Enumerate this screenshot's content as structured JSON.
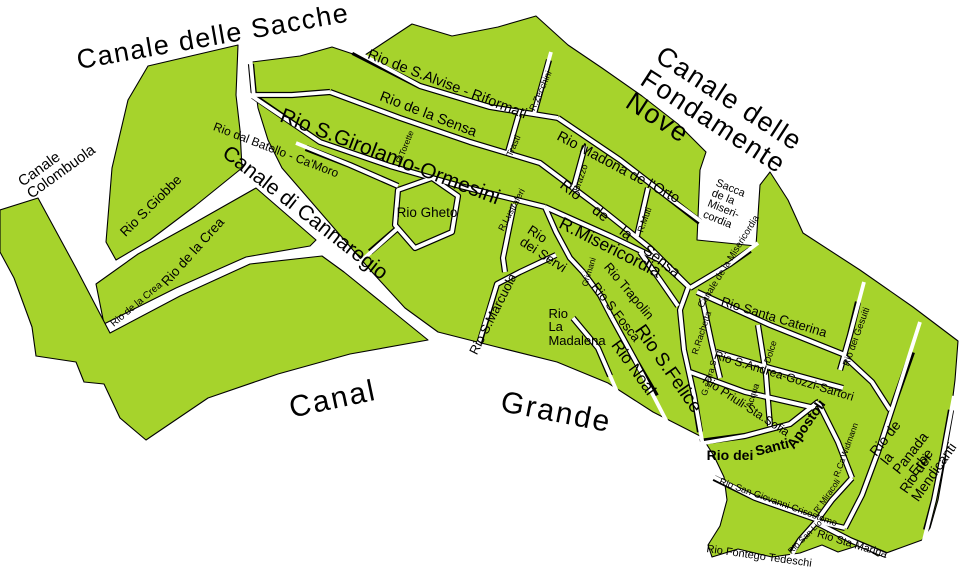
{
  "map": {
    "colors": {
      "water": "#ffffff",
      "land": "#a6d32c",
      "outline": "#000000",
      "text": "#000000"
    },
    "labels": [
      {
        "id": "canale-delle-sacche",
        "text": "Canale delle Sacche",
        "x": 213,
        "y": 37,
        "rot": -10,
        "size": 27,
        "kind": "water",
        "ls": 1.5
      },
      {
        "id": "canale-delle-fondamente-nove",
        "text": "Canale delle Fondamente Nove",
        "x": 737,
        "y": 137,
        "rot": 33,
        "size": 27,
        "kind": "water",
        "ls": 1.5
      },
      {
        "id": "canale-colombuola",
        "text": "Canale\nColombuola",
        "x": 57,
        "y": 166,
        "rot": -36,
        "size": 15,
        "kind": "water",
        "align": "left"
      },
      {
        "id": "canal-grande-1",
        "text": "Canal",
        "x": 333,
        "y": 400,
        "rot": -12,
        "size": 30,
        "kind": "water",
        "ls": 2
      },
      {
        "id": "canal-grande-2",
        "text": "Grande",
        "x": 556,
        "y": 413,
        "rot": 11,
        "size": 30,
        "kind": "water",
        "ls": 2
      },
      {
        "id": "rio-de-s-alvise-riformati",
        "text": "Rio de S.Alvise - Riformati",
        "x": 447,
        "y": 85,
        "rot": 21,
        "size": 14.5
      },
      {
        "id": "rio-de-la-sensa-upper",
        "text": "Rio de la Sensa",
        "x": 428,
        "y": 115,
        "rot": 21,
        "size": 14.5
      },
      {
        "id": "rio-madona-de-l-orto",
        "text": "Rio Madona de l'Orto",
        "x": 618,
        "y": 168,
        "rot": 28,
        "size": 14.5
      },
      {
        "id": "rio-s-girolamo-ormesini",
        "text": "Rio S.Girolamo-Ormesini",
        "x": 390,
        "y": 157,
        "rot": 21,
        "size": 21
      },
      {
        "id": "rio-dal-batello-ca-moro",
        "text": "Rio dal Batello - Ca'Moro",
        "x": 276,
        "y": 150,
        "rot": 21,
        "size": 12
      },
      {
        "id": "canale-di-cannaregio",
        "text": "Canale di Cannaregio",
        "x": 305,
        "y": 213,
        "rot": 38,
        "size": 21
      },
      {
        "id": "rio-gheto",
        "text": "Rio Gheto",
        "x": 427,
        "y": 213,
        "rot": 0,
        "size": 13.5
      },
      {
        "id": "rio-s-giobbe",
        "text": "Rio S.Giobbe",
        "x": 151,
        "y": 206,
        "rot": -45,
        "size": 13.5
      },
      {
        "id": "rio-de-la-crea",
        "text": "Rio de la Crea",
        "x": 193,
        "y": 252,
        "rot": -48,
        "size": 13.5
      },
      {
        "id": "rio-de-la-crea-small",
        "text": "Rio de la Crea",
        "x": 137,
        "y": 305,
        "rot": -40,
        "size": 10
      },
      {
        "id": "r-zecchini",
        "text": "R.Zecchini",
        "x": 541,
        "y": 91,
        "rot": -66,
        "size": 9
      },
      {
        "id": "trasti",
        "text": "Trasti",
        "x": 514,
        "y": 146,
        "rot": -66,
        "size": 9
      },
      {
        "id": "r-torette",
        "text": "R.Torette",
        "x": 405,
        "y": 147,
        "rot": -68,
        "size": 8.5
      },
      {
        "id": "r-lustraferi",
        "text": "R.Lustraferi",
        "x": 512,
        "y": 210,
        "rot": -62,
        "size": 9
      },
      {
        "id": "brazzo",
        "text": "Brazzo",
        "x": 581,
        "y": 178,
        "rot": -71,
        "size": 9
      },
      {
        "id": "r-muti",
        "text": "R.Muti",
        "x": 645,
        "y": 220,
        "rot": -70,
        "size": 9
      },
      {
        "id": "rio-de-la-sensa-spread",
        "text": "Rio de la Sensa",
        "x": 620,
        "y": 229,
        "rot": 38,
        "size": 15,
        "ws": 14
      },
      {
        "id": "r-misericordia",
        "text": "R.Misericordia",
        "x": 610,
        "y": 248,
        "rot": 27,
        "size": 17.5
      },
      {
        "id": "rio-dei-servi",
        "text": "Rio\ndei Servi",
        "x": 547,
        "y": 249,
        "rot": 33,
        "size": 13.5,
        "align": "left"
      },
      {
        "id": "grimani",
        "text": "Grimani",
        "x": 589,
        "y": 272,
        "rot": -73,
        "size": 8.5
      },
      {
        "id": "rio-trapolin",
        "text": "Rio Trapolin",
        "x": 629,
        "y": 291,
        "rot": 50,
        "size": 13
      },
      {
        "id": "rio-s-fosca",
        "text": "Rio S.Fosca",
        "x": 616,
        "y": 312,
        "rot": 52,
        "size": 13
      },
      {
        "id": "rio-s-marcuola",
        "text": "Rio S.Marcuola",
        "x": 493,
        "y": 314,
        "rot": -63,
        "size": 13
      },
      {
        "id": "rio-la-madalena",
        "text": "Rio\nLa\nMadalena",
        "x": 577,
        "y": 327,
        "rot": 0,
        "size": 13,
        "align": "left"
      },
      {
        "id": "rio-noal",
        "text": "Rio Noal",
        "x": 633,
        "y": 368,
        "rot": 54,
        "size": 16.5
      },
      {
        "id": "rio-s-felice",
        "text": "Rio S.Felice",
        "x": 668,
        "y": 369,
        "rot": 55,
        "size": 19
      },
      {
        "id": "sacca-de-la-misericordia",
        "text": "Sacca\nde la\nMiseri-\ncordia",
        "x": 725,
        "y": 205,
        "rot": 22,
        "size": 11,
        "align": "left"
      },
      {
        "id": "canale-de-la-misericordia",
        "text": "Canale de la Misericordia",
        "x": 729,
        "y": 262,
        "rot": -58,
        "size": 9.5
      },
      {
        "id": "rio-santa-caterina",
        "text": "Rio Santa Caterina",
        "x": 774,
        "y": 317,
        "rot": 17,
        "size": 13
      },
      {
        "id": "r-rachetta",
        "text": "R.Rachetta",
        "x": 702,
        "y": 333,
        "rot": -72,
        "size": 9
      },
      {
        "id": "rio-s-andrea-gozzi-sartori",
        "text": "Rio S.Andrea-Gozzi-Sartori",
        "x": 784,
        "y": 376,
        "rot": 17,
        "size": 12
      },
      {
        "id": "giserra-s",
        "text": "G.serra.S",
        "x": 709,
        "y": 378,
        "rot": -74,
        "size": 8.5
      },
      {
        "id": "dolce",
        "text": "Dolce",
        "x": 771,
        "y": 352,
        "rot": -72,
        "size": 9
      },
      {
        "id": "acqua",
        "text": "Acqua",
        "x": 753,
        "y": 396,
        "rot": -72,
        "size": 9
      },
      {
        "id": "rio-priuli-sta-sofia",
        "text": "Rio Priuli-Sta.Sofia",
        "x": 746,
        "y": 406,
        "rot": 33,
        "size": 12
      },
      {
        "id": "rio-dei-gesuiti",
        "text": "Rio dei Gesuiti",
        "x": 857,
        "y": 337,
        "rot": -70,
        "size": 9.5
      },
      {
        "id": "rio-de-la-panada-erbe",
        "text": "Rio de la Panada - Erbe",
        "x": 906,
        "y": 446,
        "rot": -52,
        "size": 14
      },
      {
        "id": "rio-dei-mendicanti",
        "text": "Rio dei Mendicanti",
        "x": 928,
        "y": 468,
        "rot": -55,
        "size": 14
      },
      {
        "id": "rio-dei",
        "text": "Rio dei",
        "x": 730,
        "y": 455,
        "rot": 0,
        "size": 14,
        "bold": true
      },
      {
        "id": "santi",
        "text": "Santi",
        "x": 772,
        "y": 447,
        "rot": -14,
        "size": 14,
        "bold": true
      },
      {
        "id": "apostoli",
        "text": "Apostoli",
        "x": 806,
        "y": 424,
        "rot": -55,
        "size": 14,
        "bold": true
      },
      {
        "id": "r-ca-widmann",
        "text": "R.Ca'Widmann",
        "x": 846,
        "y": 450,
        "rot": -70,
        "size": 8.5
      },
      {
        "id": "rio-san-giovanni-crisostomo",
        "text": "Rio San Giovanni Crisostomo",
        "x": 778,
        "y": 503,
        "rot": 20,
        "size": 9.5
      },
      {
        "id": "r-miracoli",
        "text": "R' Miracoli",
        "x": 827,
        "y": 496,
        "rot": -55,
        "size": 8.5
      },
      {
        "id": "rio-san-lio",
        "text": "Rio San Lio",
        "x": 805,
        "y": 537,
        "rot": -45,
        "size": 8.5
      },
      {
        "id": "rio-sta-marina",
        "text": "Rio Sta Marina",
        "x": 852,
        "y": 545,
        "rot": 17,
        "size": 11
      },
      {
        "id": "rio-fontego-tedeschi",
        "text": "Rio Fontego Tedeschi",
        "x": 759,
        "y": 557,
        "rot": 8,
        "size": 11
      }
    ]
  }
}
